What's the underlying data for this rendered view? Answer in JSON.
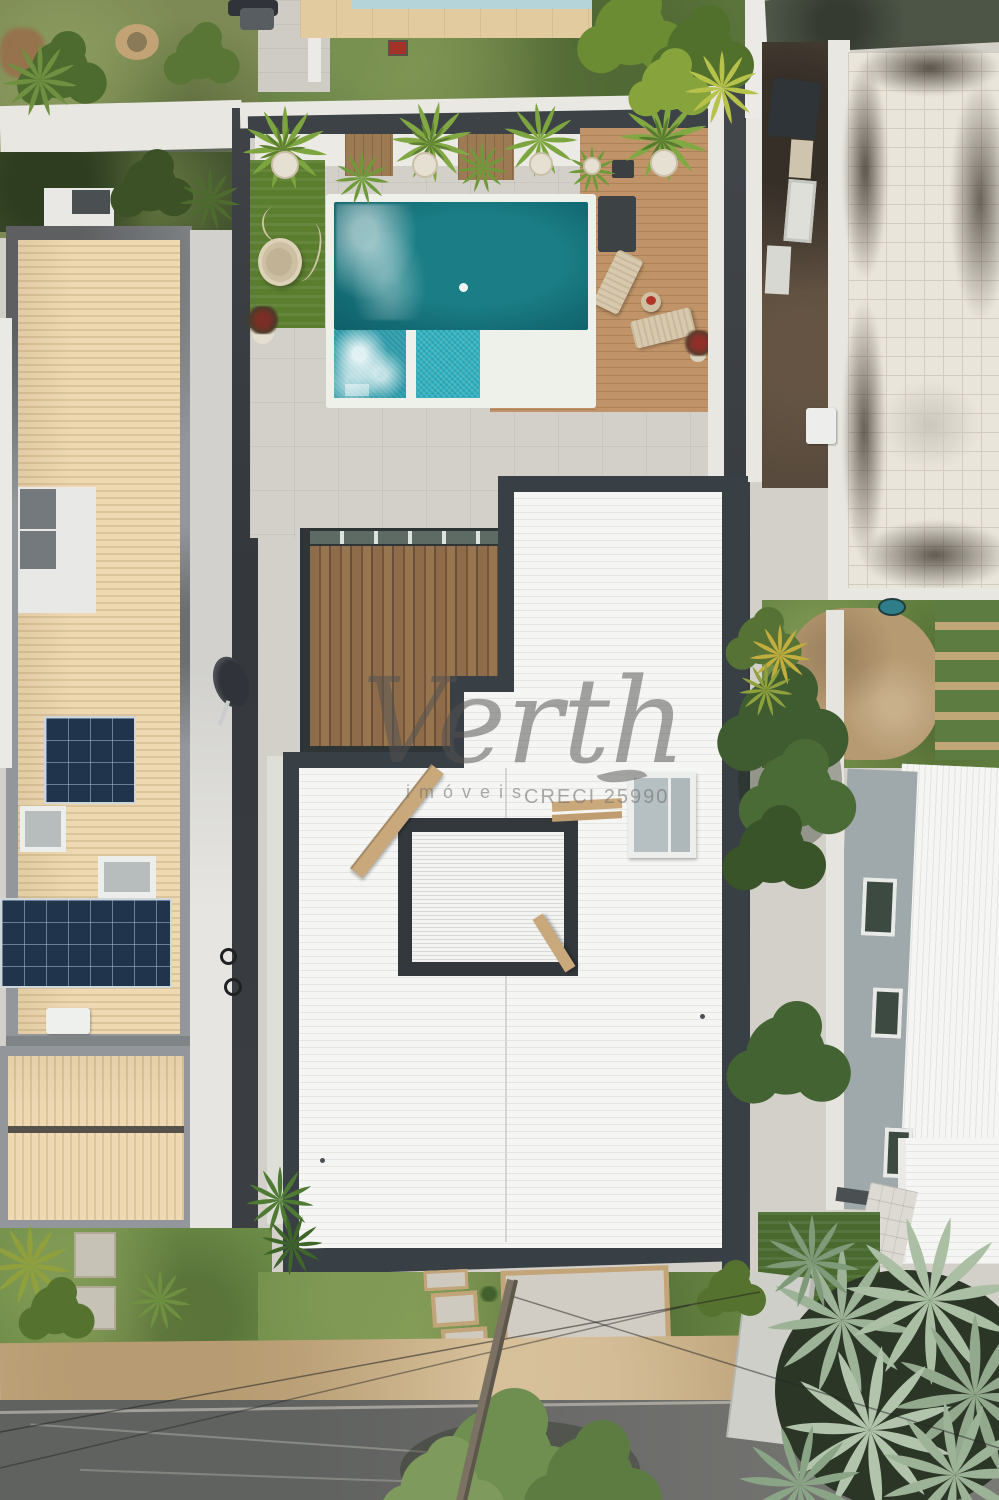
{
  "image_type": "aerial-drone-photograph-of-residential-property",
  "watermark": {
    "brand": "Verth",
    "subtitle": "imóveis",
    "license": "CRECI 25990"
  },
  "palette": {
    "pool_deep_teal": "#17727b",
    "pool_whirlpool": "#2a98a6",
    "pool_shallow_turquoise": "#2eb0bf",
    "pool_coping_white": "#eef0ea",
    "deck_wood": "#b98f63",
    "pergola_wood": "#87664a",
    "main_roof_white": "#f3f3f1",
    "parapet_charcoal": "#394045",
    "left_house_roof_tan": "#e9d5ae",
    "solar_pv_blue": "#20344c",
    "solar_thermal_gray": "#74797e",
    "patio_concrete": "#d3d0c9",
    "lawn_green": "#6d8c48",
    "artificial_grass": "#5a7d2e",
    "neighbor_tiled_roof": "#eae5db",
    "street_asphalt": "#6c6c6a",
    "sidewalk_sand": "#c9b189",
    "palm_silver_green": "#a9bda4"
  },
  "scene": {
    "regions": [
      {
        "name": "left-neighbor-house",
        "feature": "tan corrugated roof with solar panels and skylights"
      },
      {
        "name": "main-property",
        "feature": "pool, wood deck, pergola, white corrugated roof"
      },
      {
        "name": "right-neighbor",
        "feature": "white-tiled flat roof, backyard, gray-walled house"
      },
      {
        "name": "street",
        "feature": "asphalt road with utility pole, wires and tree canopy"
      },
      {
        "name": "bottom-right",
        "feature": "silver bismarck palm over lawn"
      }
    ]
  }
}
